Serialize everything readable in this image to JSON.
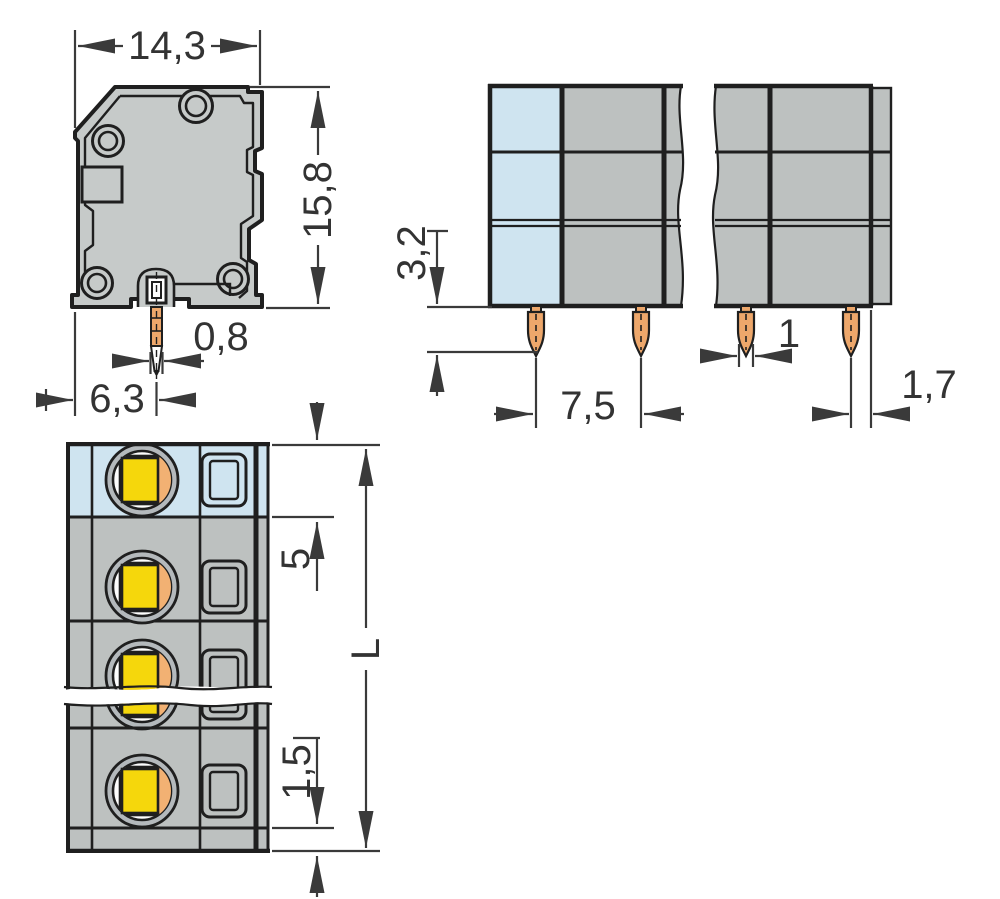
{
  "drawing": {
    "title": "terminal-block-dimensional-drawing",
    "colors": {
      "housing_gray": "#c6cac9",
      "front_gray": "#bdc1c0",
      "pole_blue": "#cfe4f0",
      "ring_gray": "#b4b9bc",
      "pin_orange": "#eda76b",
      "clamp_orange": "#f2b173",
      "button_yellow": "#f5d70c",
      "line": "#1f1f1f",
      "dimension": "#3a3a3a"
    },
    "views": {
      "side_view": {
        "name": "side-view",
        "dims": {
          "width": {
            "label": "14,3"
          },
          "height": {
            "label": "15,8"
          },
          "pin_width": {
            "label": "0,8"
          },
          "pin_offset": {
            "label": "6,3"
          }
        }
      },
      "front_view": {
        "name": "front-view",
        "dims": {
          "pin_length": {
            "label": "3,2"
          },
          "pin_pitch": {
            "label": "7,5"
          },
          "pin_width": {
            "label": "1"
          },
          "end_offset": {
            "label": "1,7"
          }
        }
      },
      "top_view": {
        "name": "top-view",
        "dims": {
          "first_pole_offset": {
            "label": "5"
          },
          "total_length": {
            "label": "L"
          },
          "bottom_edge": {
            "label": "1,5"
          }
        }
      }
    }
  }
}
